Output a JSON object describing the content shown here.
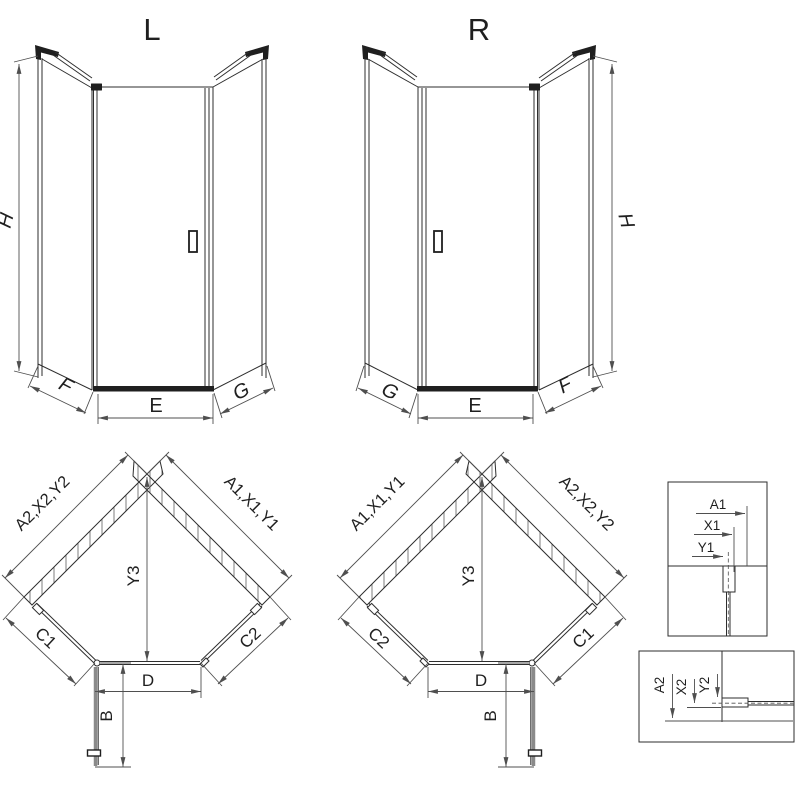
{
  "colors": {
    "background": "#ffffff",
    "line": "#2e2e2e",
    "dimension_line": "#4f4f4f",
    "dark_fill": "#1f1f1f",
    "open_door_gray": "#8a8a8a"
  },
  "elevation_left": {
    "title": "L",
    "height_label": "H",
    "left_bottom_label": "F",
    "front_bottom_label": "E",
    "right_bottom_label": "G"
  },
  "elevation_right": {
    "title": "R",
    "height_label": "H",
    "left_bottom_label": "G",
    "front_bottom_label": "E",
    "right_bottom_label": "F"
  },
  "plan_left": {
    "left_wall_label": "A2,X2,Y2",
    "right_wall_label": "A1,X1,Y1",
    "center_label": "Y3",
    "left_side_label": "C1",
    "right_side_label": "C2",
    "front_label": "D",
    "door_swing_label": "B"
  },
  "plan_right": {
    "left_wall_label": "A1,X1,Y1",
    "right_wall_label": "A2,X2,Y2",
    "center_label": "Y3",
    "left_side_label": "C2",
    "right_side_label": "C1",
    "front_label": "D",
    "door_swing_label": "B"
  },
  "detail_top_right": {
    "labels": [
      "A1",
      "X1",
      "Y1"
    ]
  },
  "detail_bottom_right": {
    "labels": [
      "A2",
      "X2",
      "Y2"
    ]
  }
}
